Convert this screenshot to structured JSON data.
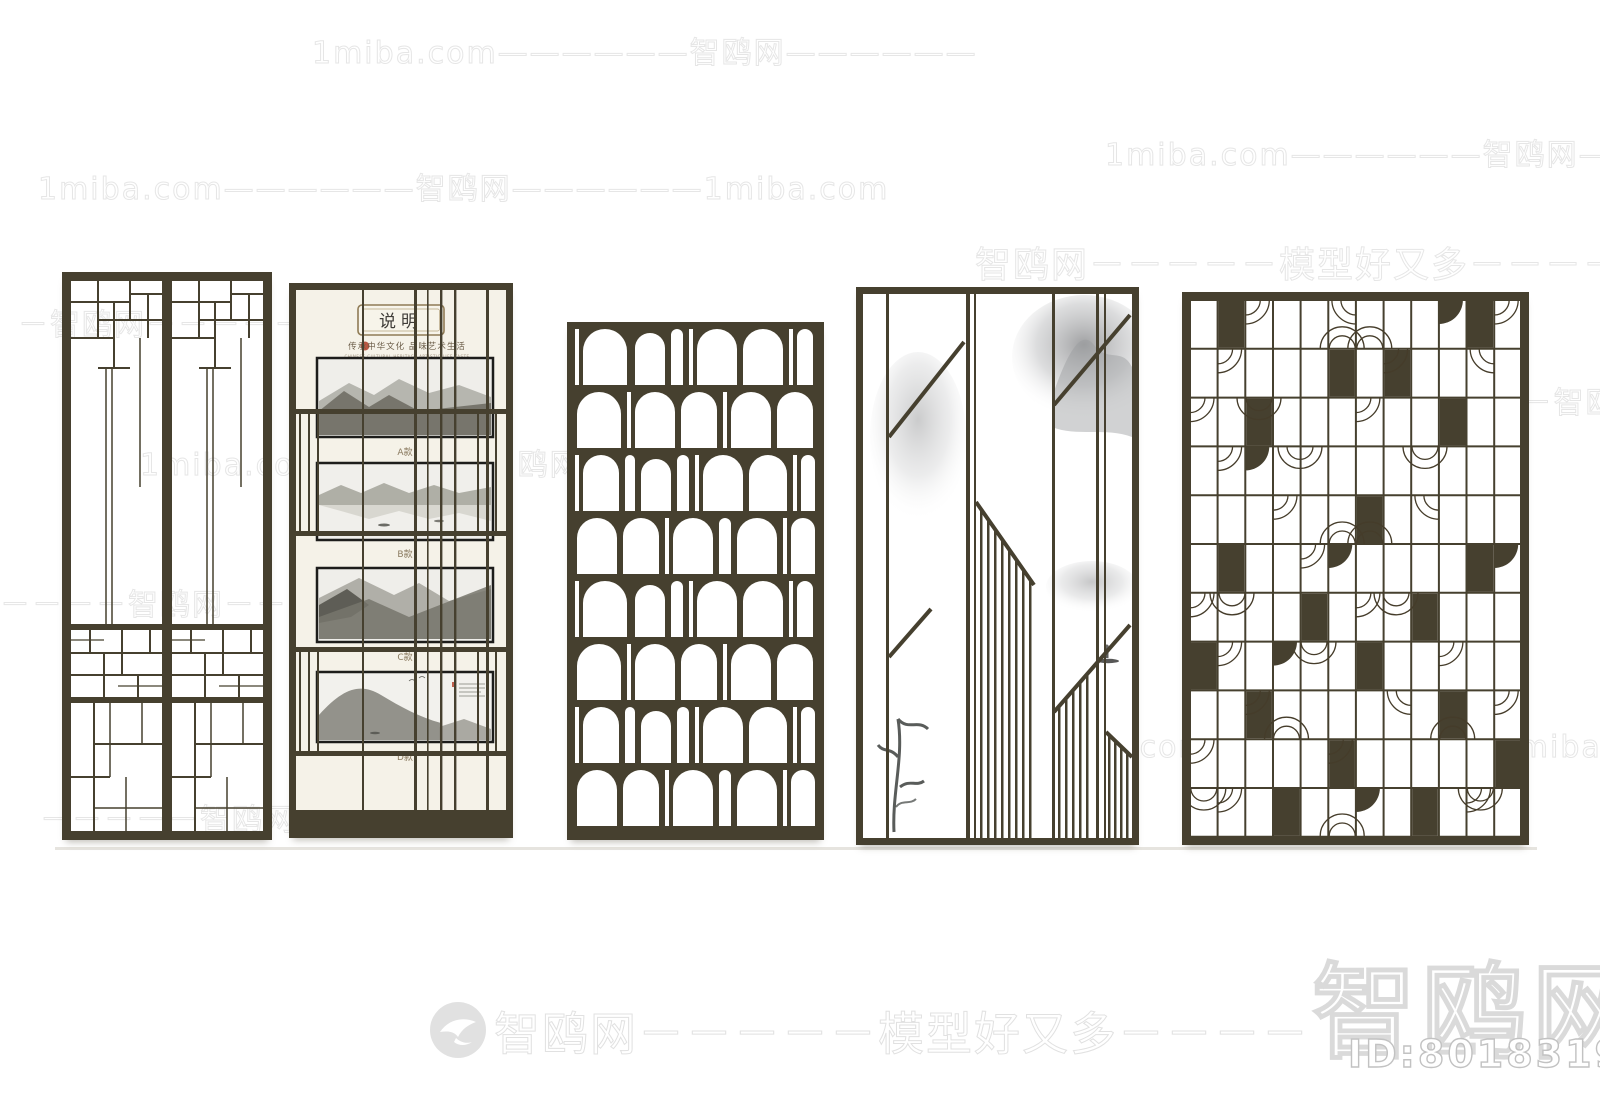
{
  "meta": {
    "site": "1miba.com",
    "brand": "智鸥网",
    "tagline": "模型好又多",
    "model_id": "ID:801831961"
  },
  "watermarks": {
    "row_top": "1miba.com——————智鸥网——————",
    "row_right": "1miba.com——————智鸥网———",
    "row_left": "1miba.com——————智鸥网——————1miba.com",
    "row_brand_right": "智鸥网－－－－－模型好又多－－－－",
    "row_p1_top": "－智鸥网－－－－－－",
    "row_mid": "1miba.com－－－－－智鸥网－－－－－",
    "row_p5": "1miba.com－－－－智鸥网－－",
    "row_p1_mid": "－－－－智鸥网－－－－",
    "row_lower_right": "－－1miba.com－－－－智鸥网－－1miba.c",
    "row_bottom_left": "－－－－－智鸥网－－－－－",
    "footer": "智鸥网－－－－－模型好又多－－－－",
    "big_brand": "智鸥网",
    "id": "ID:801831961"
  },
  "panel2": {
    "title": "说明",
    "subtitle": "传承中华文化 品味艺术生活",
    "subtitle_en": "CHINESE CULTURAL HERITAGE ARTISTIC LIFE TASTE",
    "labels": [
      "A款",
      "B款",
      "C款",
      "D款"
    ]
  },
  "panels": [
    {
      "name": "chinese-lattice-double-door-screen"
    },
    {
      "name": "design-specification-panel-with-four-ink-painting-variants"
    },
    {
      "name": "arched-openings-partition-screen"
    },
    {
      "name": "vertical-slat-diagonal-screen-with-ink-landscape"
    },
    {
      "name": "fan-scale-grid-partition-screen"
    }
  ],
  "colors": {
    "frame": "#46402f",
    "cream": "#f5f2e8",
    "ink_dark": "#5c5b54",
    "ink_light": "#a8a7a0",
    "seal_red": "#b5452f",
    "watermark": "#e4e4e4"
  }
}
